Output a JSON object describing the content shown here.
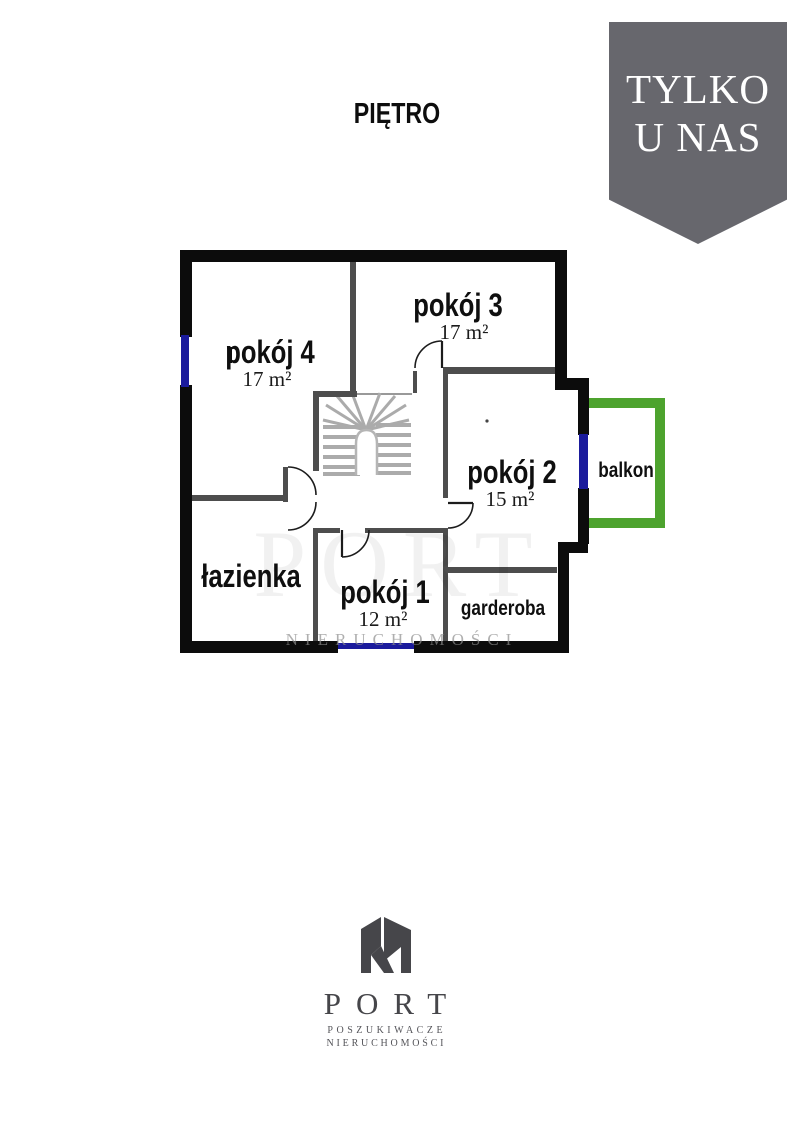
{
  "page_title": "PIĘTRO",
  "badge": {
    "line1": "TYLKO",
    "line2": "U NAS",
    "background": "#67676d",
    "text_color": "#ffffff"
  },
  "plan": {
    "colors": {
      "outer_wall": "#0c0c0c",
      "interior_wall": "#4d4d4d",
      "window": "#1b1b9c",
      "balcony": "#4da32e",
      "stairs": "#ababab"
    },
    "rooms": {
      "pokoj4": {
        "name": "pokój 4",
        "area": "17 m²"
      },
      "pokoj3": {
        "name": "pokój 3",
        "area": "17 m²"
      },
      "pokoj2": {
        "name": "pokój 2",
        "area": "15 m²"
      },
      "pokoj1": {
        "name": "pokój 1",
        "area": "12 m²"
      },
      "lazienka": {
        "name": "łazienka"
      },
      "garderoba": {
        "name": "garderoba"
      },
      "balkon": {
        "name": "balkon"
      }
    },
    "watermark": {
      "big": "PORT",
      "line": "NIERUCHOMOŚCI"
    }
  },
  "logo": {
    "name": "PORT",
    "tagline1": "POSZUKIWACZE",
    "tagline2": "NIERUCHOMOŚCI",
    "color": "#46464a"
  }
}
